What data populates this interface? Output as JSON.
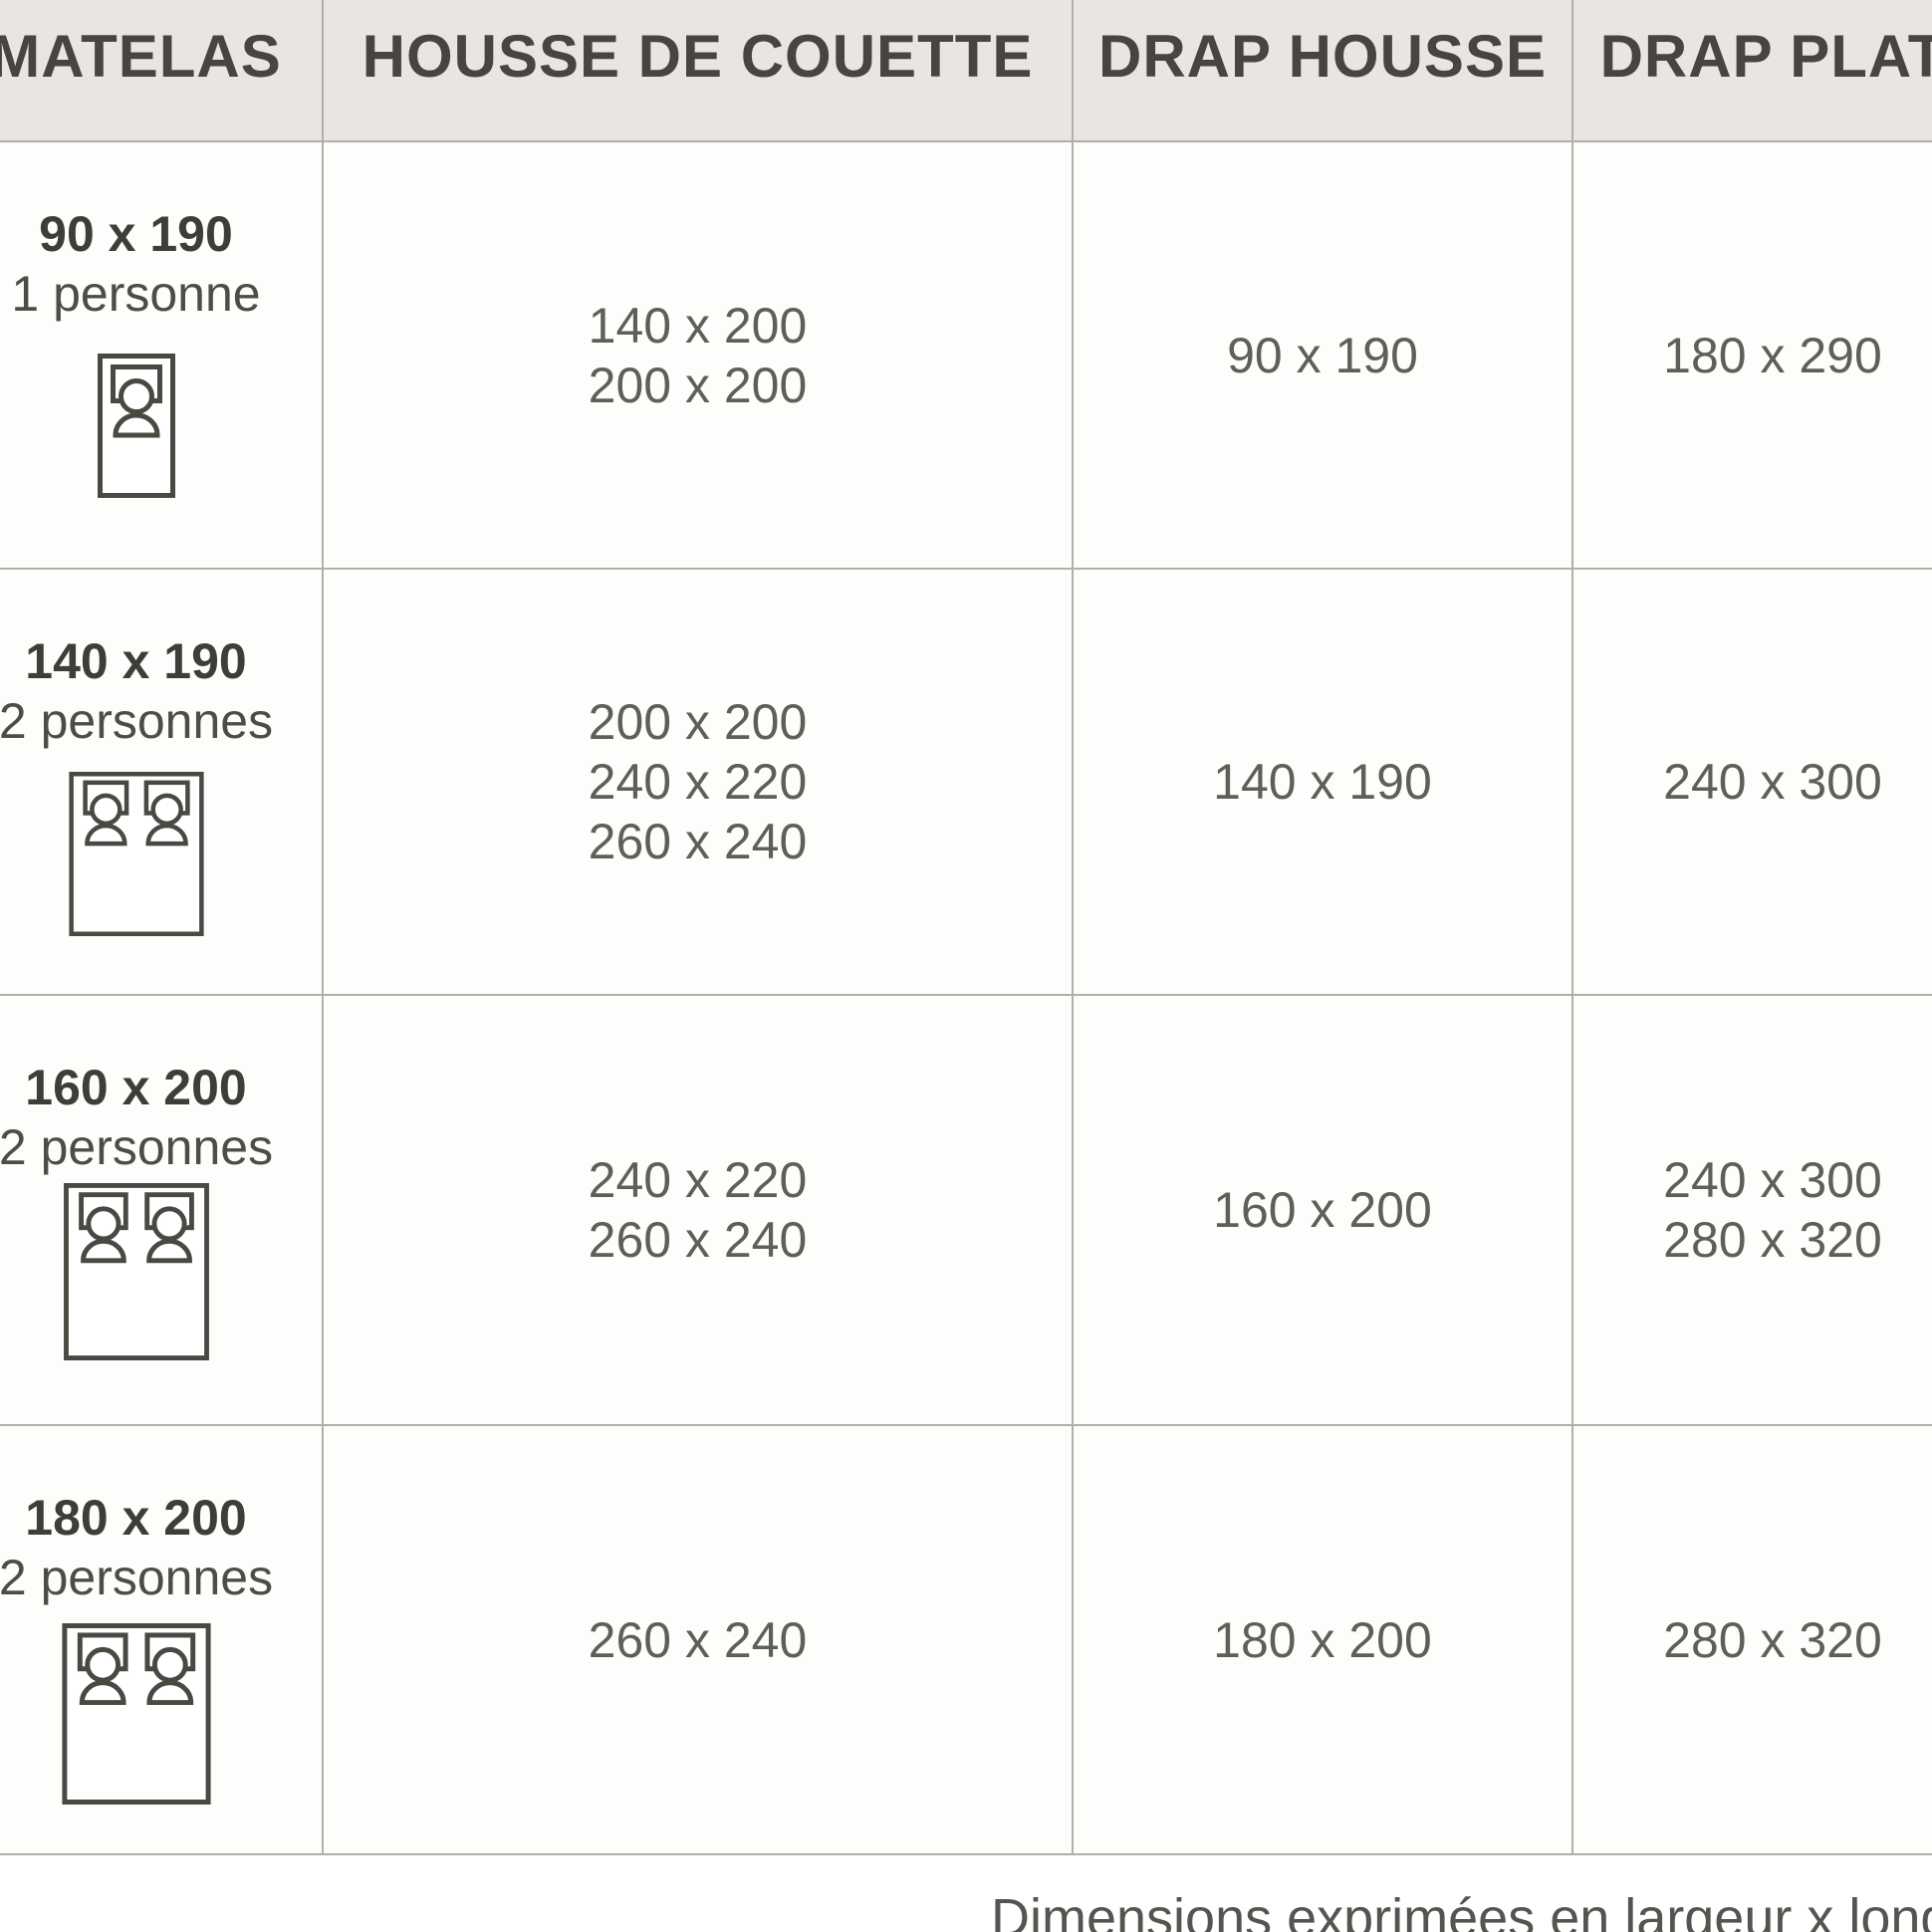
{
  "table": {
    "columns": [
      "MATELAS",
      "HOUSSE DE COUETTE",
      "DRAP HOUSSE",
      "DRAP PLAT"
    ],
    "rows": [
      {
        "matelas_size": "90 x 190",
        "persons": "1 personne",
        "bed_icon": "single-bed-icon",
        "housse_de_couette": [
          "140 x 200",
          "200 x 200"
        ],
        "drap_housse": "90 x 190",
        "drap_plat": [
          "180 x 290"
        ]
      },
      {
        "matelas_size": "140 x 190",
        "persons": "2 personnes",
        "bed_icon": "double-bed-icon",
        "housse_de_couette": [
          "200 x 200",
          "240 x 220",
          "260 x 240"
        ],
        "drap_housse": "140 x 190",
        "drap_plat": [
          "240 x 300"
        ]
      },
      {
        "matelas_size": "160 x 200",
        "persons": "2 personnes",
        "bed_icon": "double-bed-icon",
        "housse_de_couette": [
          "240 x 220",
          "260 x 240"
        ],
        "drap_housse": "160 x 200",
        "drap_plat": [
          "240 x 300",
          "280 x 320"
        ]
      },
      {
        "matelas_size": "180 x 200",
        "persons": "2 personnes",
        "bed_icon": "double-bed-icon",
        "housse_de_couette": [
          "260 x 240"
        ],
        "drap_housse": "180 x 200",
        "drap_plat": [
          "280 x 320"
        ]
      }
    ],
    "footnote": "Dimensions exprimées en largeur x longueur (cm)"
  },
  "colors": {
    "header_background": "#e9e6e1",
    "border": "#b2afa9",
    "header_text": "#47453f",
    "cell_text": "#605e58",
    "row_title_text": "#3f3d38",
    "icon_stroke": "#4a4842",
    "footnote_text": "#56544e"
  }
}
